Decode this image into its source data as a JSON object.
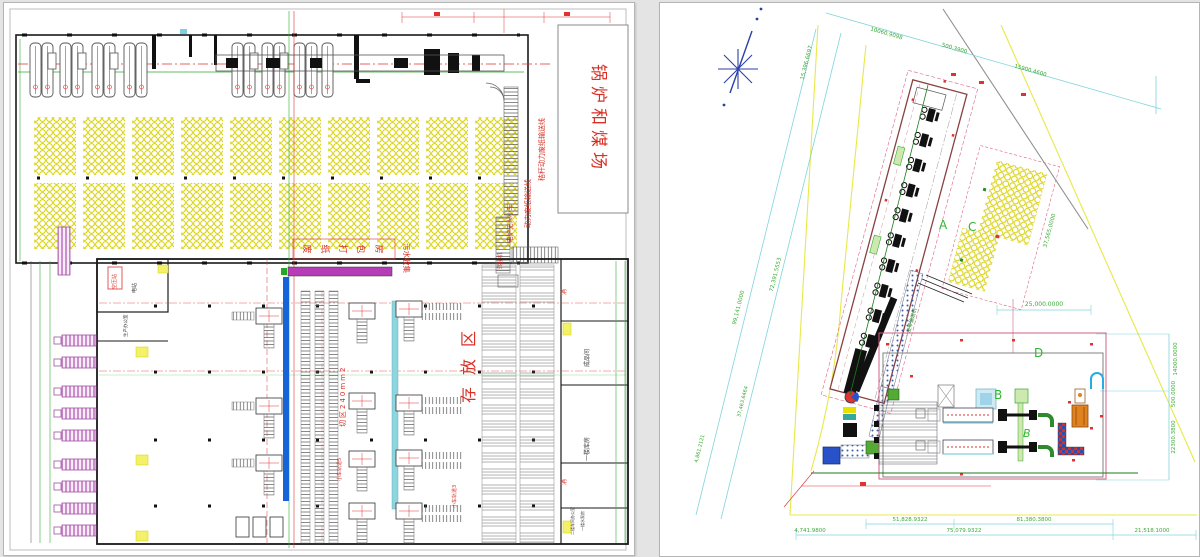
{
  "palette": {
    "annotation_red": "#d93025",
    "dimension_green": "#3aaa35",
    "dimension_cyan": "#7fd4dc",
    "bale_yellow": "#d6ce00",
    "site_boundary_yellow": "#e8e84a",
    "conveyor_blue": "#1565d8",
    "conveyor_cyan": "#8fd5de",
    "equipment_magenta": "#b73cb7",
    "truck_purple": "#bb66bb",
    "compass_blue": "#2a3fa8",
    "building_outline": "#8a4040",
    "orange_machine": "#e0821e"
  },
  "left_sheet": {
    "labels": {
      "boiler_coal_yard": "锅炉和煤场",
      "straw_power_conveyor": "秸秆动力废纸输送线",
      "power_conveyor": "动力废纸输送线",
      "agv_cart": "电炉无人小车",
      "transfer_machine": "转接机",
      "baling_room_chars": [
        "废",
        "纸",
        "打",
        "包",
        "房"
      ],
      "sewage_collection": "污水收集",
      "storage_area": "存放区",
      "cutting_area": "切区240mm2",
      "cart_rail_5": "小车轨道5",
      "cart_rail_3": "小车轨道3",
      "air_compressor_station": "空压站",
      "power_station": "电站",
      "production_office": "生产办公室",
      "finished_goods_room": "成品间",
      "first_floor_warehouse": "一楼库房",
      "second_floor_office": "二楼车间办公室",
      "pump_room": "一楼水泵房",
      "fire_hydrant": "消"
    }
  },
  "right_sheet": {
    "zones": {
      "a": "A",
      "b": "B",
      "b_italic": "B",
      "c": "C",
      "d": "D"
    },
    "belt_conveyor": "皮带输送机",
    "dims": {
      "top": [
        "10060.9098",
        "500.3900",
        "15900.4600"
      ],
      "left_top": "15,396.6697",
      "left_mid": "72,391.5553",
      "left_outer": "99,141.0000",
      "left_lower": "37,463.6464",
      "left_lower2": "4,861.2121",
      "right1": "14000.0000",
      "right2": "500.0000",
      "right3": "22300.3800",
      "width_mid": "25,000.0000",
      "c_side": "37,565.0000",
      "b1": "51,828.9322",
      "b2": "81,380.3800",
      "b3": "4,741.9800",
      "b4": "75,079.9322",
      "b5": "21,518.1000"
    }
  }
}
